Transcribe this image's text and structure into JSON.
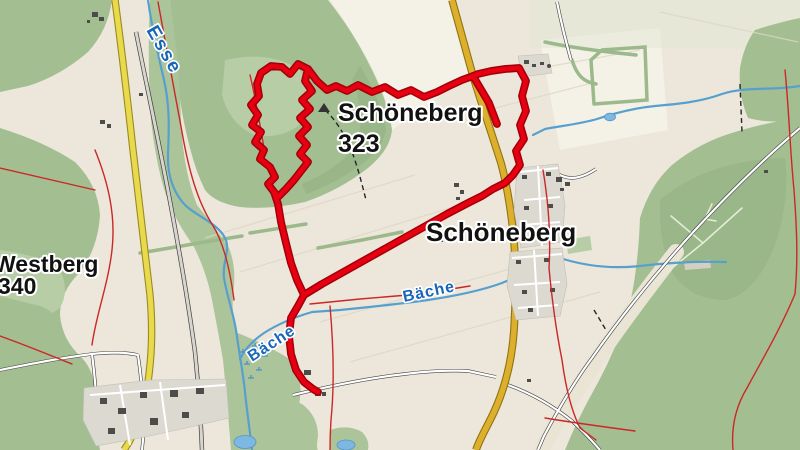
{
  "labels": {
    "river_top": "Esse",
    "stream_mid": "Bäche",
    "stream_mid_2": "Bäche",
    "hill_name": "Schöneberg",
    "hill_elevation": "323",
    "town_name": "Schöneberg",
    "west_hill_name": "Westberg",
    "west_hill_elevation": "340"
  },
  "colors": {
    "bg": "#ece7da",
    "field-light": "#f4f1e7",
    "forest": "#a3bf92",
    "forest-dark": "#90ad7e",
    "forest-light": "#b7cda6",
    "water": "#57a0ce",
    "water-fill": "#7db8e2",
    "water-label": "#1766b8",
    "route": "#e60011",
    "route-casing": "#a00008",
    "road-yellow": "#e9d94d",
    "road-yellow-casing": "#9a8b20",
    "road-ochre": "#dcb02c",
    "road-ochre-casing": "#8f7312",
    "road-casing": "#3f3f3f",
    "road-gray-fill": "#d8d5ce",
    "trail-red": "#cc2727",
    "urban": "#dcd9d1",
    "building": "#4c4c4a",
    "hedge": "#9cb98c",
    "path-light": "#e3ecd6",
    "dash-black": "#262626",
    "corridor": "#eae4d5",
    "label-dark": "#111111"
  },
  "paths": {
    "route_main": "M497,124 L489,103 L473,76 L462,80 L449,86 L437,92 L424,97 L411,90 L398,95 L385,87 L372,92 L358,85 L347,91 L336,86 L327,90 L317,81 L308,69 L298,64 L290,74 L282,67 L271,66 L261,73 L257,84 L259,96 L251,105 L258,115 L252,125 L261,132 L255,142 L264,150 L260,159 L270,167 L275,177 L268,184 L274,192 L278,204 L281,222 L286,243 L291,263 L297,280 L304,295 L298,306 L291,318 L289,336 L291,354 L296,370 L304,382 L313,389 L318,392",
    "route_east": "M304,295 L322,284 L347,270 L372,256 L397,242 L422,228 L447,214 L468,203 L482,196 L493,189 L505,183 L513,175 L520,165 L516,151 L524,139 L520,125 L526,111 L522,96 L526,81 L519,68 L505,69 L491,71 L478,74 L473,76",
    "route_zigzag": "M308,69 L305,81 L312,91 L302,100 L310,109 L300,118 L308,127 L299,136 L307,145 L300,154 L308,162 L301,171 L294,180 L286,189 L278,197 L274,192",
    "esse": "M148,0 C152,28 158,54 164,80 C170,106 169,130 168,154 C167,176 174,194 186,206 C200,218 218,224 225,238 C231,250 222,262 224,278 C227,296 233,312 236,330 C239,352 243,372 245,392 C247,412 250,431 252,450",
    "baeche_west": "M560,258 C540,266 522,275 502,283 C480,291 455,296 428,300 C400,304 370,307 340,310 L312,312 C295,317 278,324 264,333 C252,341 244,351 240,359",
    "baeche_east": "M560,258 C585,266 612,269 640,266 C665,263 695,261 726,262",
    "stream_ne": "M800,86 C770,91 746,86 722,94 C700,102 678,104 655,106 C635,108 615,113 597,119 C580,124 560,126 545,129 L533,135",
    "yellow_west": "M115,0 C121,45 127,95 133,150 C139,205 145,255 150,295 C153,330 152,360 146,395 C141,420 133,437 124,450",
    "yellow_east": "M452,0 C459,25 466,50 473,76 C483,108 493,138 501,163 C507,185 511,210 514,240 C516,270 516,300 514,330 C512,360 505,388 494,412 C487,427 480,438 476,450",
    "gray_road": "M136,32 C148,92 161,152 172,212 C181,260 189,308 195,352 C199,392 201,422 202,450",
    "white_diag": "M800,128 C760,162 722,200 686,240 C652,278 620,318 592,358 C574,382 558,410 544,436 L538,450",
    "white_bottom1": "M293,395 C330,386 368,378 405,374 C428,371 448,370 468,371 L496,377",
    "white_bottom2": "M508,385 C530,393 552,405 572,421 C585,433 594,443 600,450",
    "white_ne": "M557,2 C561,22 566,42 571,60",
    "white_village_n": "M514,176 C528,170 544,168 560,175 C572,181 584,177 596,169",
    "white_bl1": "M0,370 C30,364 60,358 92,354 C110,352 125,352 138,355",
    "white_bl2": "M138,355 C142,382 144,412 143,440 L142,450",
    "white_bl3": "M92,354 C96,385 98,415 97,445",
    "trail_1": "M158,2 C166,45 174,90 182,132 C189,172 198,202 212,224 C224,243 230,270 234,300",
    "trail_2": "M330,306 C333,340 335,380 331,420 C330,435 330,443 330,450",
    "trail_3": "M310,304 L360,299 L408,295 L445,290 L470,286",
    "trail_4": "M250,75 C256,100 260,125 264,148",
    "trail_5": "M95,150 C108,182 116,215 112,250 C108,285 96,315 92,345",
    "trail_5b": "M0,168 C30,175 60,182 95,190",
    "trail_5c": "M0,336 C28,346 52,356 72,364",
    "trail_6": "M543,170 C548,200 551,235 549,268 C552,300 556,330 562,360 C566,390 572,412 580,428 L596,440",
    "trail_7": "M785,70 C789,110 790,150 794,190 C797,230 798,262 795,294 C780,330 762,360 747,388 C736,406 731,427 733,450",
    "trail_8": "M545,418 C575,423 605,427 635,431",
    "dash_peak": "M325,110 C336,120 345,135 352,152 C358,168 362,184 366,200",
    "dash_ne": "M740,84 L742,132",
    "dash_br": "M594,310 L606,330",
    "hedge_1": "M545,42 C563,46 588,50 636,55",
    "hedge_2": "M594,104 L591,60 L602,50 L645,47 L647,100 L594,104",
    "hedge_3": "M572,60 C577,76 584,82 596,84",
    "hedge_4": "M140,253 L205,242 L242,236",
    "hedge_5": "M250,233 L306,224",
    "hedge_6": "M318,248 L362,240 L402,232",
    "fpath_1": "M645,290 L703,243",
    "fpath_2": "M703,243 L671,216",
    "fpath_3": "M703,243 L742,208",
    "fpath_4": "M712,204 L705,219 L716,221"
  }
}
